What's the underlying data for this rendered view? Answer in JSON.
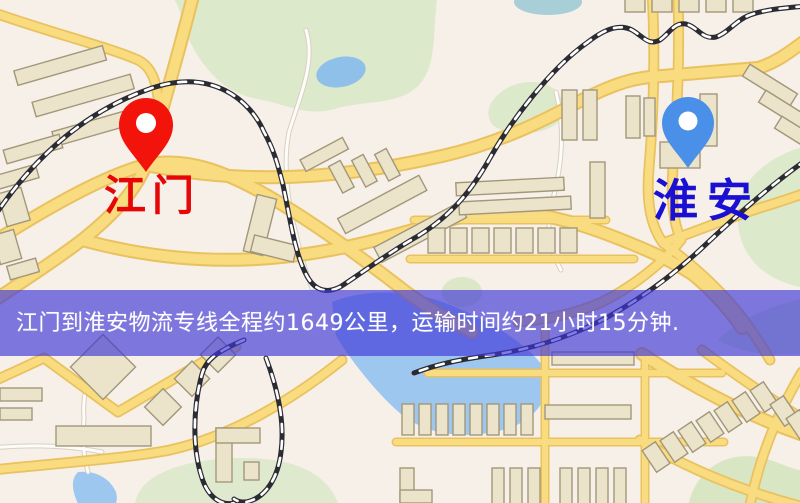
{
  "map": {
    "origin": {
      "label": "江门",
      "pin_color": "#f2140b",
      "label_color": "#e60606"
    },
    "destination": {
      "label": "淮安",
      "pin_color": "#4a90e8",
      "label_color": "#1a10d4"
    },
    "style_colors": {
      "land": "#f7f0e8",
      "park_green": "#dde9cb",
      "water_blue": "#9ec7ef",
      "road_yellow": "#f9db80",
      "road_casing": "#e9c25f",
      "railway_black": "#2b2b33",
      "building_fill": "#ebe3ca"
    }
  },
  "banner": {
    "text": "江门到淮安物流专线全程约1649公里，运输时间约21小时15分钟.",
    "background_color": "#3e36d8",
    "text_color": "#ffffff"
  },
  "route": {
    "origin": "江门",
    "destination": "淮安",
    "distance_text": "约1649公里",
    "duration_text": "约21小时15分钟"
  }
}
